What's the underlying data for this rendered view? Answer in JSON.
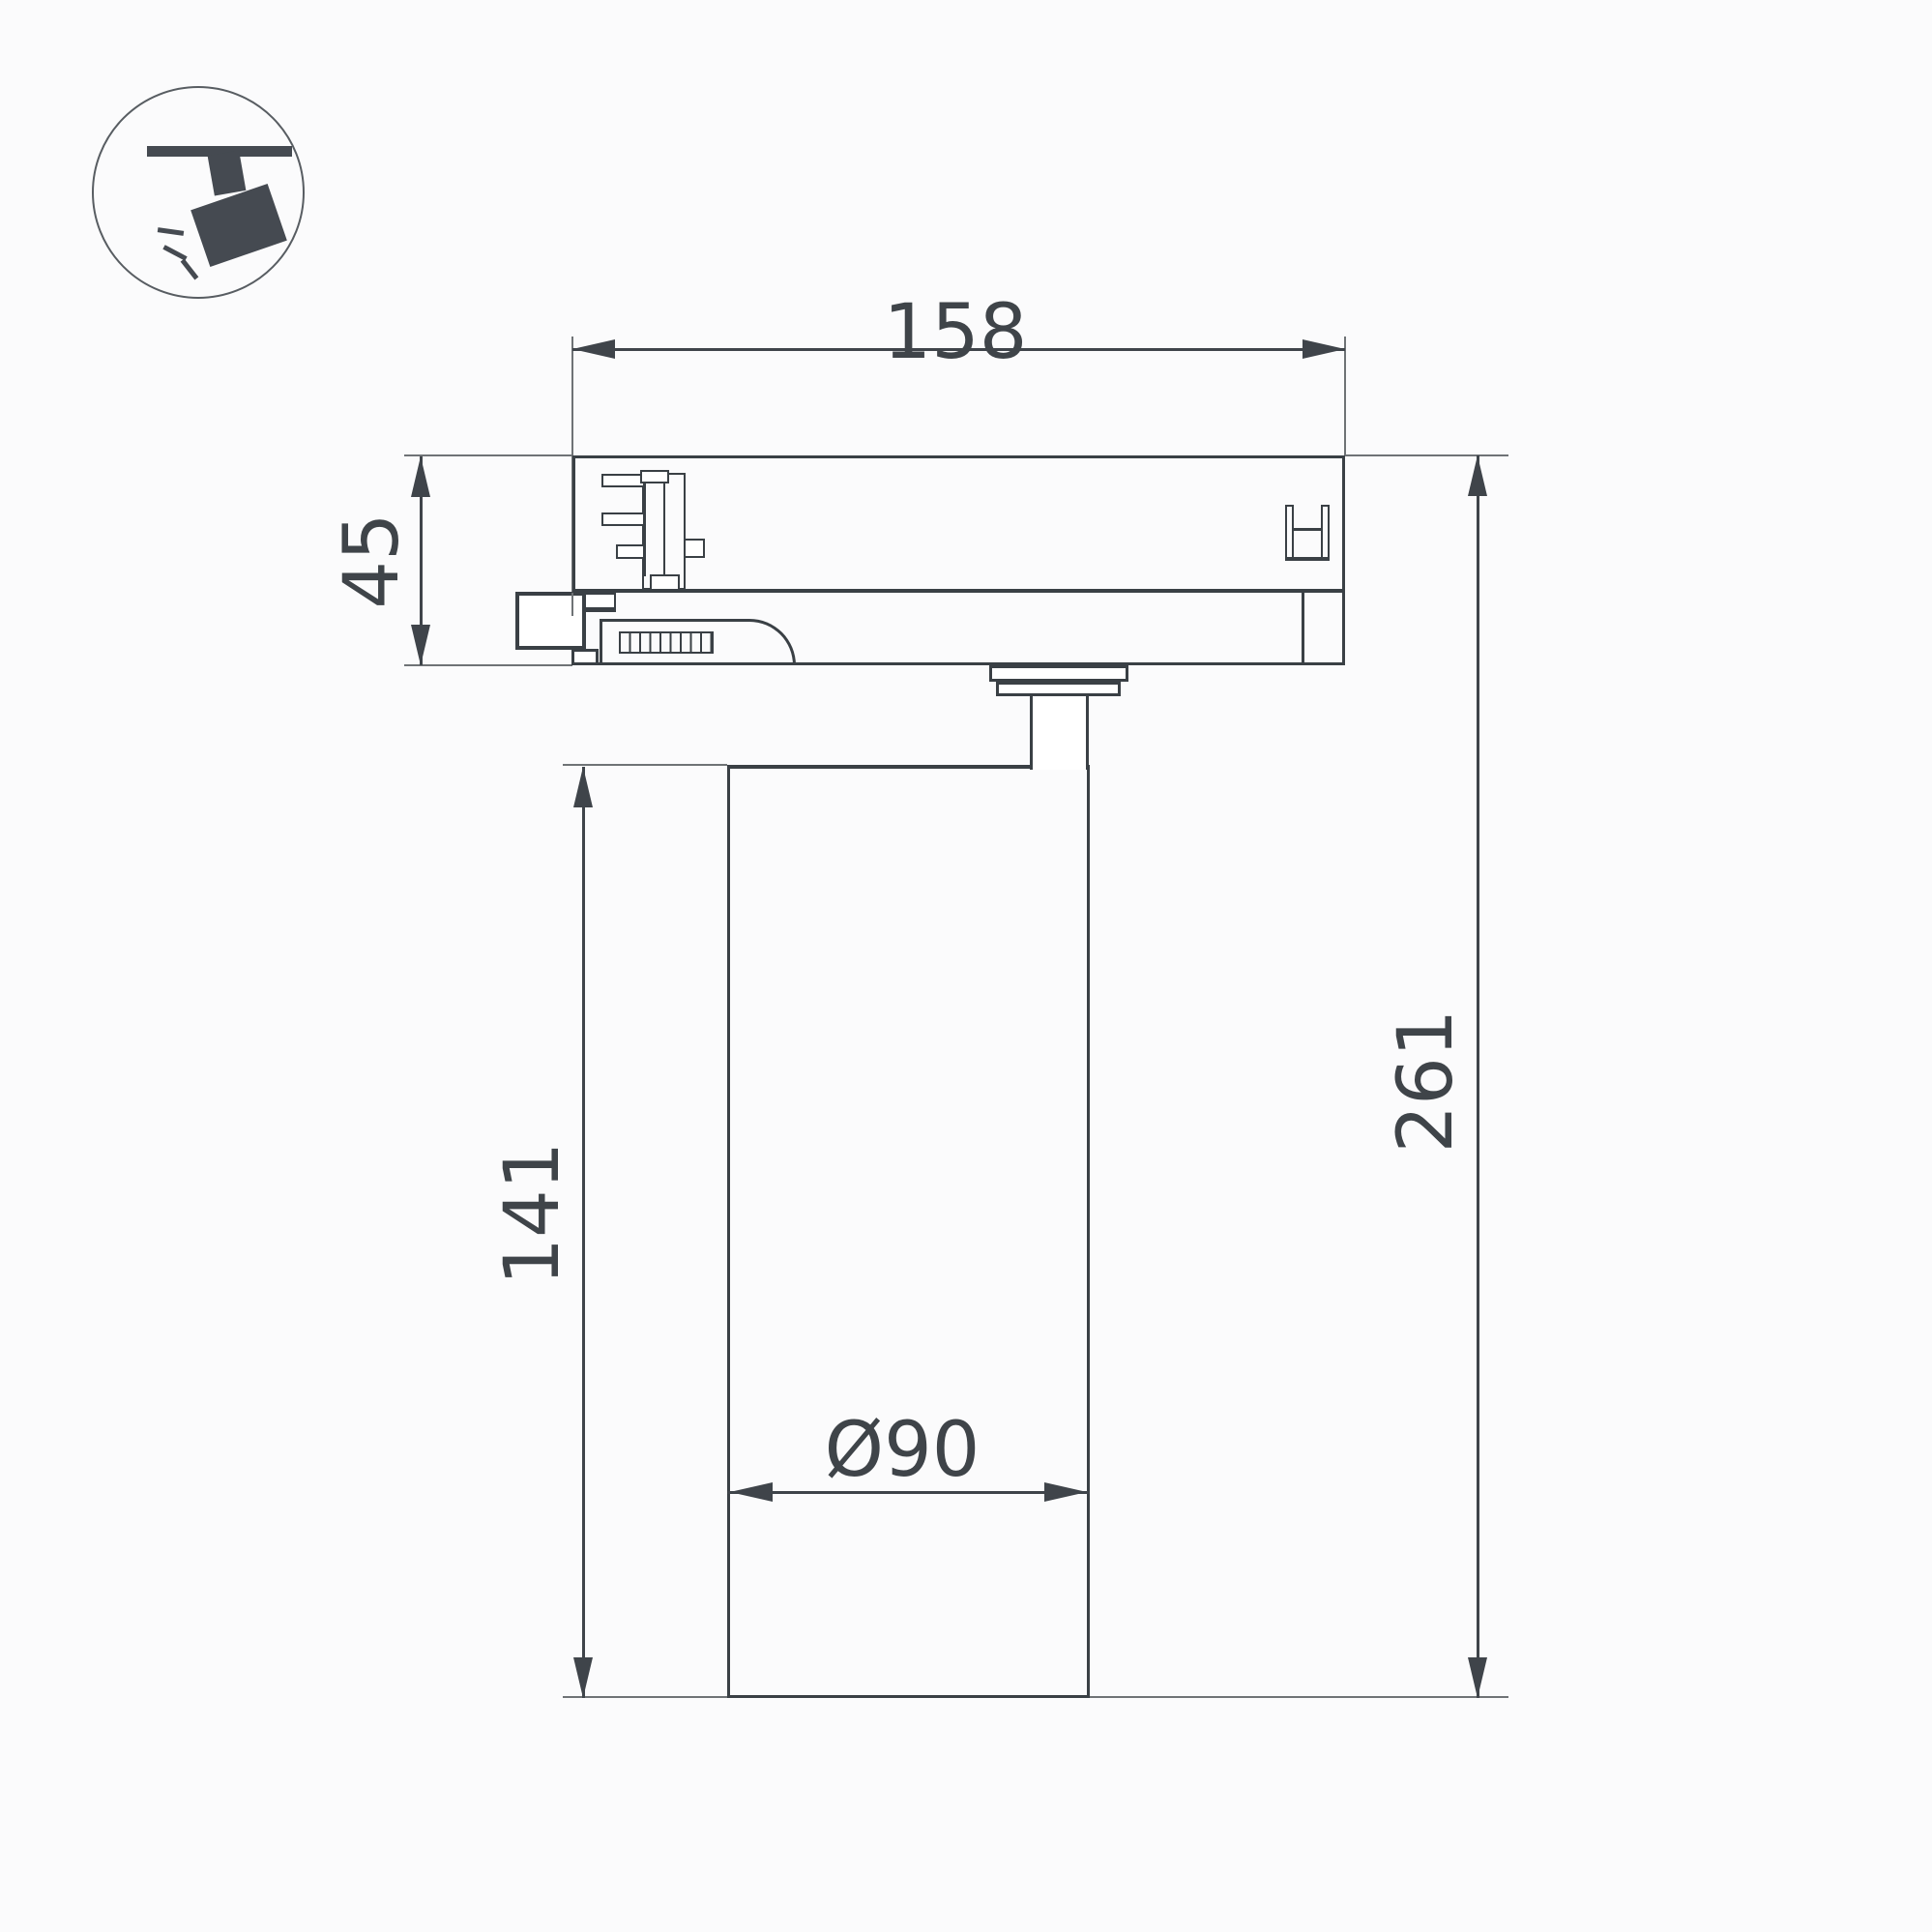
{
  "drawing": {
    "type": "technical-dimension-drawing",
    "subject": "track-mounted spotlight luminaire, side view",
    "labels": {
      "width": "158",
      "adapter_height": "45",
      "body_height": "141",
      "total_height": "261",
      "diameter": "Ø90"
    }
  },
  "icon": {
    "name": "track-spotlight-pictogram",
    "description": "ceiling track with tilted spotlight head emitting light rays"
  },
  "colors": {
    "outline": "#3a4045",
    "thin": "#6f7376",
    "arrow": "#3f444a",
    "text": "#3f4449",
    "icon": "#454a51",
    "icon_circle": "#585d62",
    "background": "#fbfbfc"
  }
}
